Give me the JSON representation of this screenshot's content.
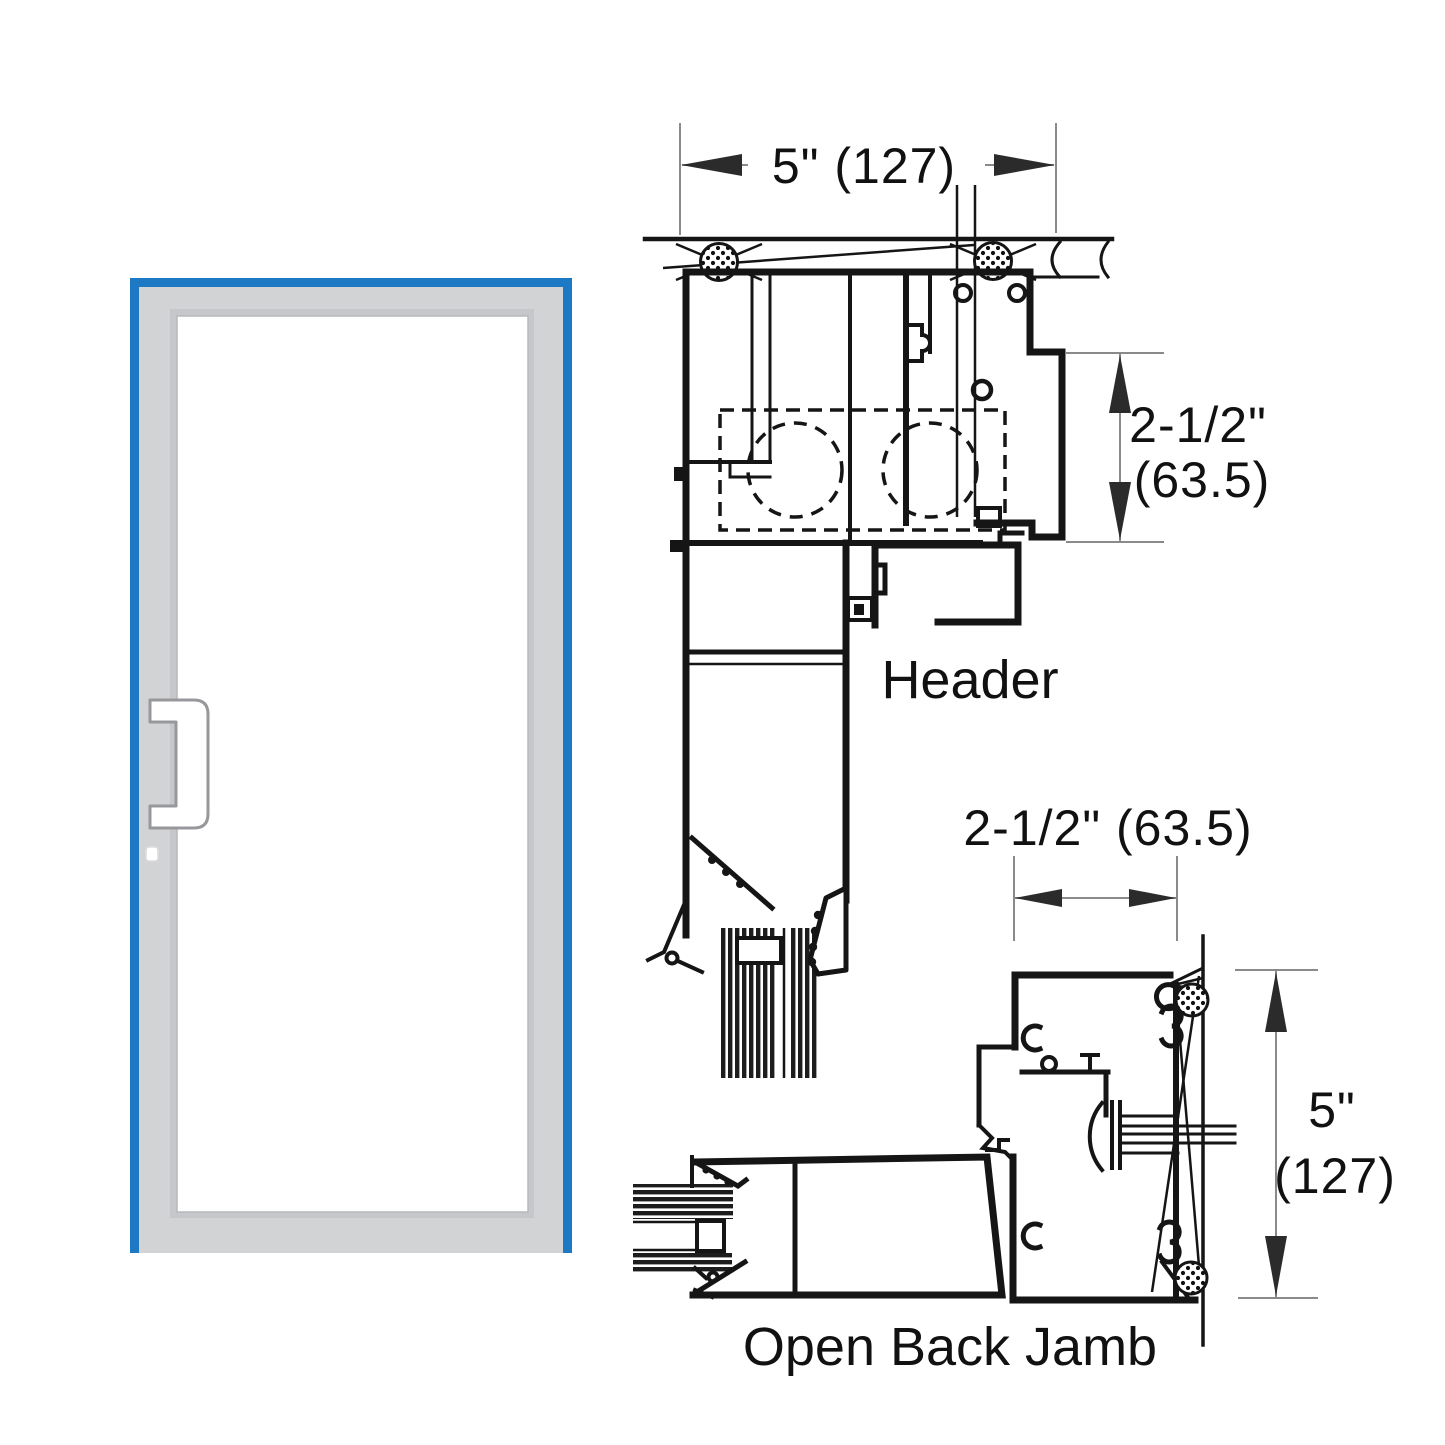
{
  "diagram_title": "Door header and open back jamb section details",
  "colors": {
    "accent_blue": "#1e79c5",
    "frame_gray": "#d2d3d5",
    "bevel_gray": "#c6c7ca",
    "line_black": "#151515",
    "dim_gray": "#8a8a8a"
  },
  "door_elevation": {
    "glass": "clear",
    "handle": "offset-pull-handle"
  },
  "header_detail": {
    "label": "Header",
    "width_dim": "5\" (127)",
    "height_dim_line1": "2-1/2\"",
    "height_dim_line2": "(63.5)"
  },
  "jamb_detail": {
    "label": "Open Back Jamb",
    "width_dim": "2-1/2\" (63.5)",
    "height_dim_line1": "5\"",
    "height_dim_line2": "(127)"
  }
}
